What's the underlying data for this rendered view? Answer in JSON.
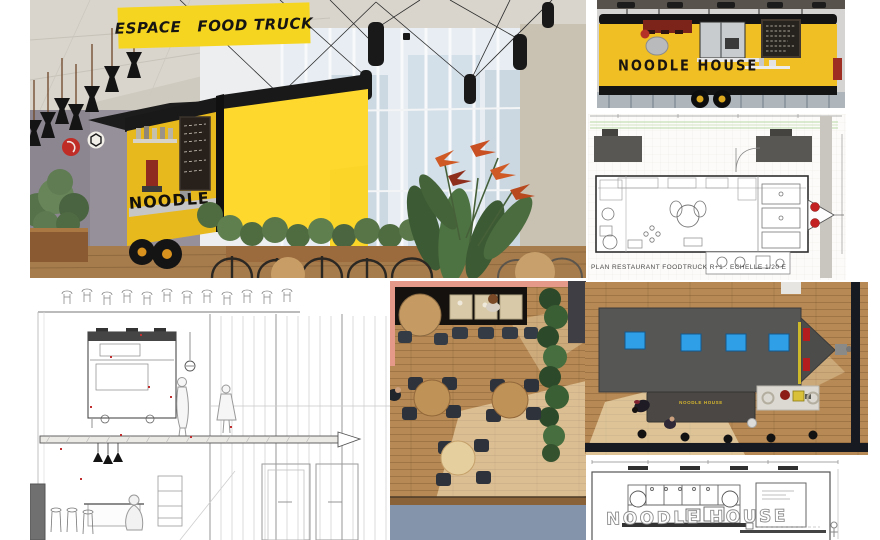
{
  "board": {
    "title": {
      "word1": "ESPACE",
      "word2": "FOOD TRUCK"
    },
    "truck": {
      "name": "NOODLE HOUSE"
    },
    "plan": {
      "caption": "PLAN  RESTAURANT FOODTRUCK  R+1 .  ECHELLE 1/20 E"
    },
    "elevation": {
      "name": "NOODLE HOUSE"
    },
    "overhead": {
      "counter_sign": "NOODLE HOUSE"
    },
    "colors": {
      "truck_yellow": "#F2C320",
      "bright_yellow": "#FFD82E",
      "label_yellow": "#F6D520",
      "accent_black": "#161616",
      "skylight_blue": "#2F9FE8",
      "tail_light_red": "#C42222",
      "wood_floor": "#B78A55",
      "walkway_blue": "#8394AB",
      "salmon": "#E59A89",
      "chalkboard": "#26221D",
      "plan_green": "#B6D8A2"
    }
  }
}
